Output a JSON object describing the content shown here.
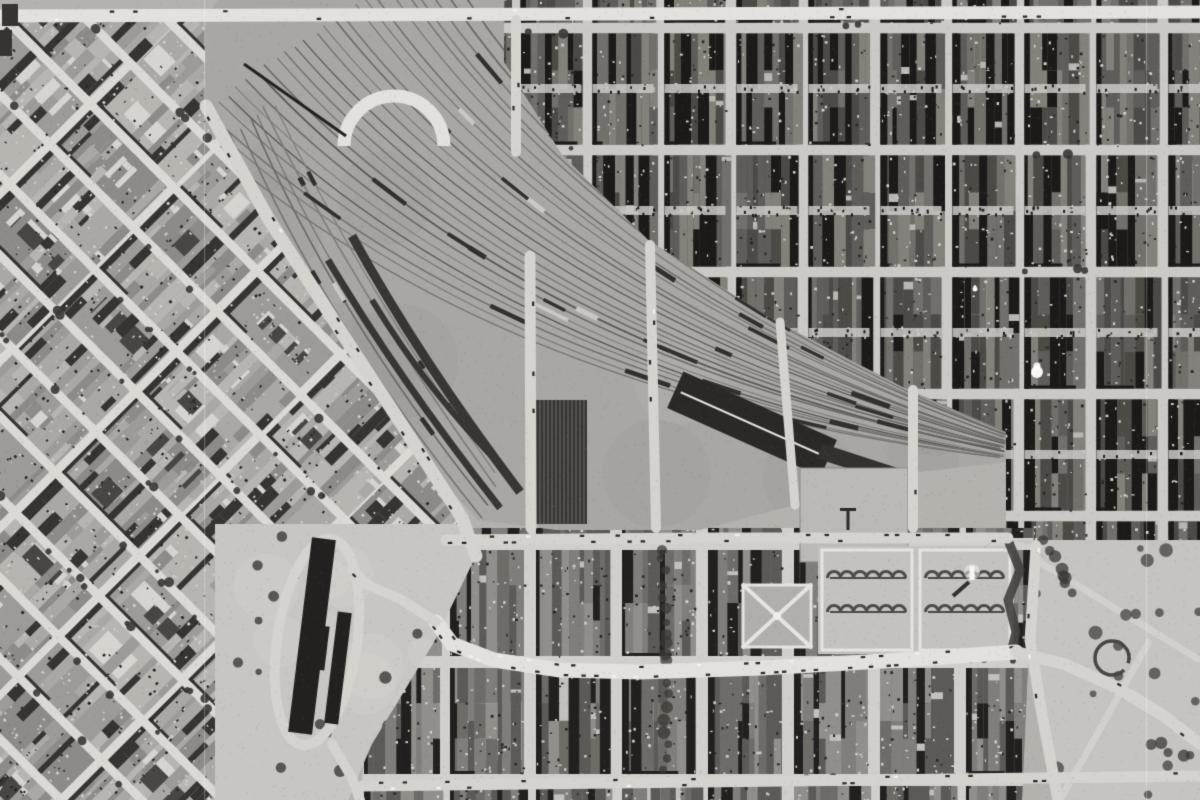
{
  "meta": {
    "width": 1200,
    "height": 800
  },
  "scene": {
    "description": "black-and-white historical aerial photograph of a city: diagonal railway yard through center, diagonal street grid at left, dense orthogonal rowhouse grid upper right, curved main street with parked cars, formal gardens with monument, traffic circle and open plaza lower right",
    "seed": 987654321,
    "palette": {
      "film_base": "#b3b1ad",
      "street": "#d3d1cd",
      "street_bright": "#e0deda",
      "shadow_deep": "#1f1d1b",
      "yard_ground": "#a8a6a2",
      "track_tones": [
        "#747270",
        "#6a6866",
        "#7e7c7a",
        "#5a5856"
      ],
      "train_dark": "#333131",
      "train_light": "#c9c7c3",
      "shed_dark": "#2d2b29",
      "park": "#c6c4c0",
      "tree": "#3d3b37",
      "hedge": "#4e4c48",
      "white_speck": "#f4f3f0"
    },
    "district_styles": {
      "light": {
        "street": "#d8d6d2",
        "bld": [
          "#8d8b87",
          "#9c9a96",
          "#a9a7a3",
          "#b5b3af"
        ],
        "shadow": "#383632",
        "roof": "#d4d2ce",
        "strip": 0.55,
        "court": 0.5,
        "tree": 0.5
      },
      "dark": {
        "street": "#c9c7c3",
        "bld": [
          "#4e4c48",
          "#605e5a",
          "#72706c",
          "#838179"
        ],
        "shadow": "#1f1d1b",
        "roof": "#b7b5b1",
        "strip": 1.0,
        "court": 0.12,
        "tree": 0.05
      },
      "mid": {
        "street": "#cfcdc9",
        "bld": [
          "#5d5b57",
          "#6f6d69",
          "#807e7a",
          "#918f8b"
        ],
        "shadow": "#252321",
        "roof": "#c1bfbb",
        "strip": 0.85,
        "court": 0.28,
        "tree": 0.1
      }
    },
    "districts": [
      {
        "name": "left-diagonal-district",
        "style": "light",
        "angle": 45,
        "cell": [
          118,
          57
        ],
        "street_w": 9,
        "alley": false,
        "poly": [
          [
            0,
            20
          ],
          [
            212,
            20
          ],
          [
            212,
            108
          ],
          [
            342,
            332
          ],
          [
            465,
            518
          ],
          [
            478,
            556
          ],
          [
            433,
            642
          ],
          [
            372,
            742
          ],
          [
            348,
            800
          ],
          [
            0,
            800
          ]
        ]
      },
      {
        "name": "rowhouse-district",
        "style": "dark",
        "angle": 0,
        "cell": [
          72,
          122
        ],
        "grid_offset": [
          515,
          150
        ],
        "street_w": 11,
        "alley": true,
        "poly": [
          [
            504,
            0
          ],
          [
            1200,
            0
          ],
          [
            1200,
            548
          ],
          [
            1006,
            548
          ],
          [
            1006,
            432
          ],
          [
            904,
            388
          ],
          [
            770,
            318
          ],
          [
            648,
            240
          ],
          [
            562,
            155
          ],
          [
            504,
            62
          ]
        ]
      },
      {
        "name": "bottom-district",
        "style": "mid",
        "angle": 0,
        "cell": [
          86,
          118
        ],
        "grid_offset": [
          530,
          544
        ],
        "street_w": 12,
        "alley": false,
        "poly": [
          [
            388,
            528
          ],
          [
            1034,
            528
          ],
          [
            1022,
            800
          ],
          [
            360,
            800
          ]
        ]
      }
    ],
    "yard": {
      "poly": [
        [
          218,
          0
        ],
        [
          504,
          0
        ],
        [
          504,
          62
        ],
        [
          562,
          155
        ],
        [
          648,
          240
        ],
        [
          770,
          318
        ],
        [
          904,
          388
        ],
        [
          1006,
          432
        ],
        [
          1006,
          462
        ],
        [
          900,
          474
        ],
        [
          795,
          505
        ],
        [
          700,
          530
        ],
        [
          556,
          530
        ],
        [
          478,
          520
        ],
        [
          430,
          468
        ],
        [
          330,
          318
        ],
        [
          205,
          102
        ],
        [
          205,
          20
        ]
      ],
      "spine": {
        "p0": [
          310,
          36
        ],
        "c": [
          545,
          318
        ],
        "p1": [
          1004,
          444
        ]
      },
      "perp0": [
        -0.82,
        0.57
      ],
      "perpC": [
        -0.6,
        0.8
      ],
      "perp1": [
        -0.32,
        0.95
      ],
      "halfw": [
        150,
        98,
        15
      ],
      "track_count": 26,
      "branch": {
        "p0": [
          252,
          118
        ],
        "c": [
          340,
          310
        ],
        "p1": [
          488,
          502
        ],
        "count": 6,
        "halfw": [
          26,
          34,
          30
        ]
      },
      "platform_arcs": [
        {
          "p0": [
            352,
            236
          ],
          "c": [
            420,
            360
          ],
          "p1": [
            520,
            492
          ],
          "w": 9
        },
        {
          "p0": [
            328,
            260
          ],
          "c": [
            398,
            378
          ],
          "p1": [
            500,
            508
          ],
          "w": 7
        },
        {
          "p0": [
            372,
            300
          ],
          "c": [
            428,
            392
          ],
          "p1": [
            505,
            470
          ],
          "w": 6
        }
      ],
      "sheds": [
        {
          "cx": 752,
          "cy": 424,
          "w": 168,
          "h": 40,
          "angle": 24,
          "fill": "#2d2b29",
          "ridge": true,
          "stripes": false
        },
        {
          "cx": 560,
          "cy": 462,
          "w": 54,
          "h": 124,
          "angle": 0,
          "fill": "#3a3836",
          "ridge": false,
          "stripes": true
        },
        {
          "cx": 872,
          "cy": 468,
          "w": 110,
          "h": 16,
          "angle": 18,
          "fill": "#353331",
          "ridge": false,
          "stripes": false
        }
      ],
      "bridges": [
        [
          244,
          64,
          346,
          136
        ],
        [
          572,
          50,
          640,
          18
        ]
      ],
      "arch": {
        "cx": 394,
        "cy": 146,
        "r": 50,
        "w": 13
      }
    },
    "roads": [
      {
        "name": "top-road",
        "pts": [
          [
            0,
            16
          ],
          [
            1200,
            12
          ]
        ],
        "w": 13,
        "tone": "bright",
        "cars": 0.12
      },
      {
        "name": "southwest-avenue",
        "pts": [
          [
            206,
            106
          ],
          [
            268,
            218
          ],
          [
            340,
            330
          ],
          [
            404,
            428
          ],
          [
            462,
            518
          ],
          [
            476,
            556
          ]
        ],
        "w": 13,
        "tone": "normal",
        "cars": 0.18
      },
      {
        "name": "yard-south-street",
        "pts": [
          [
            446,
            540
          ],
          [
            700,
            538
          ],
          [
            1008,
            538
          ]
        ],
        "w": 11,
        "tone": "normal",
        "cars": 0.5
      },
      {
        "name": "main-street",
        "pts": [
          [
            1016,
            652
          ],
          [
            900,
            660
          ],
          [
            762,
            668
          ],
          [
            640,
            672
          ],
          [
            560,
            670
          ],
          [
            494,
            660
          ],
          [
            452,
            644
          ],
          [
            436,
            622
          ]
        ],
        "w": 15,
        "tone": "bright",
        "cars": 0.75
      },
      {
        "name": "loop-connector",
        "pts": [
          [
            436,
            622
          ],
          [
            402,
            600
          ],
          [
            368,
            585
          ],
          [
            352,
            570
          ]
        ],
        "w": 10,
        "tone": "normal",
        "cars": 0.1
      },
      {
        "name": "market-south-road",
        "pts": [
          [
            332,
            744
          ],
          [
            352,
            778
          ],
          [
            360,
            800
          ]
        ],
        "w": 10,
        "tone": "normal",
        "cars": 0.0
      },
      {
        "name": "bottom-street",
        "pts": [
          [
            362,
            786
          ],
          [
            700,
            782
          ],
          [
            1040,
            778
          ],
          [
            1200,
            776
          ]
        ],
        "w": 11,
        "tone": "normal",
        "cars": 0.3
      },
      {
        "name": "plaza-southeast-road",
        "pts": [
          [
            1016,
            652
          ],
          [
            1064,
            664
          ],
          [
            1118,
            688
          ],
          [
            1164,
            716
          ],
          [
            1200,
            744
          ]
        ],
        "w": 12,
        "tone": "normal",
        "cars": 0.1
      },
      {
        "name": "plaza-vertical-road",
        "pts": [
          [
            1036,
            546
          ],
          [
            1030,
            640
          ],
          [
            1042,
            714
          ],
          [
            1058,
            800
          ]
        ],
        "w": 11,
        "tone": "normal",
        "cars": 0.1
      },
      {
        "name": "viaduct-north",
        "pts": [
          [
            516,
            20
          ],
          [
            516,
            152
          ]
        ],
        "w": 10,
        "tone": "normal",
        "cars": 0.2
      },
      {
        "name": "viaduct-1",
        "pts": [
          [
            530,
            256
          ],
          [
            531,
            528
          ]
        ],
        "w": 11,
        "tone": "normal",
        "cars": 0.2
      },
      {
        "name": "viaduct-2",
        "pts": [
          [
            650,
            245
          ],
          [
            656,
            528
          ]
        ],
        "w": 10,
        "tone": "normal",
        "cars": 0.15
      },
      {
        "name": "viaduct-3",
        "pts": [
          [
            780,
            322
          ],
          [
            795,
            505
          ]
        ],
        "w": 9,
        "tone": "normal",
        "cars": 0.1
      },
      {
        "name": "cross-street-east",
        "pts": [
          [
            913,
            390
          ],
          [
            913,
            528
          ]
        ],
        "w": 10,
        "tone": "normal",
        "cars": 0.1
      }
    ],
    "market_loop": {
      "cx": 317,
      "cy": 642,
      "rx": 40,
      "ry": 104,
      "angle": 8,
      "w": 10
    },
    "parks": {
      "market_plaza": {
        "poly": [
          [
            215,
            524
          ],
          [
            462,
            524
          ],
          [
            476,
            556
          ],
          [
            434,
            642
          ],
          [
            372,
            744
          ],
          [
            348,
            800
          ],
          [
            215,
            800
          ]
        ],
        "trees": 26
      },
      "shed": {
        "rects": [
          [
            312,
            636,
            24,
            196,
            7
          ],
          [
            338,
            668,
            14,
            112,
            7
          ],
          [
            322,
            648,
            44,
            10,
            97
          ]
        ],
        "fill": "#262422"
      },
      "t_lot": {
        "rect": [
          800,
          468,
          108,
          94
        ],
        "mark": [
          848,
          518
        ]
      },
      "garden_x": {
        "rect": [
          742,
          584,
          70,
          64
        ]
      },
      "garden_scallop": {
        "rect": [
          818,
          546,
          196,
          108
        ]
      },
      "monument": [
        972,
        576
      ],
      "hedge_s": {
        "pts": [
          [
            1008,
            540
          ],
          [
            1020,
            570
          ],
          [
            1008,
            600
          ],
          [
            1016,
            632
          ],
          [
            1010,
            656
          ]
        ],
        "w": 9
      },
      "plaza": {
        "poly": [
          [
            1012,
            540
          ],
          [
            1200,
            540
          ],
          [
            1200,
            800
          ],
          [
            1056,
            800
          ],
          [
            1040,
            700
          ],
          [
            1026,
            640
          ],
          [
            1036,
            546
          ]
        ],
        "trees": 18
      },
      "circle": [
        1112,
        658,
        17
      ],
      "tree_rows": [
        {
          "pts": [
            [
              662,
              548
            ],
            [
              668,
              660
            ],
            [
              665,
              780
            ]
          ],
          "r": 5,
          "step": 12
        },
        {
          "pts": [
            [
              1046,
              540
            ],
            [
              1064,
              576
            ],
            [
              1072,
              600
            ]
          ],
          "r": 5,
          "step": 10
        },
        {
          "pts": [
            [
              1150,
              742
            ],
            [
              1198,
              760
            ]
          ],
          "r": 5,
          "step": 11
        }
      ]
    },
    "artifacts": {
      "scratches": [
        204,
        1146
      ],
      "specks": [
        [
          1037,
          372,
          6
        ],
        [
          975,
          289,
          2.5
        ]
      ],
      "corner_marks": [
        [
          2,
          4,
          16,
          22
        ],
        [
          0,
          30,
          12,
          26
        ]
      ],
      "grain_dots": 14000
    }
  }
}
